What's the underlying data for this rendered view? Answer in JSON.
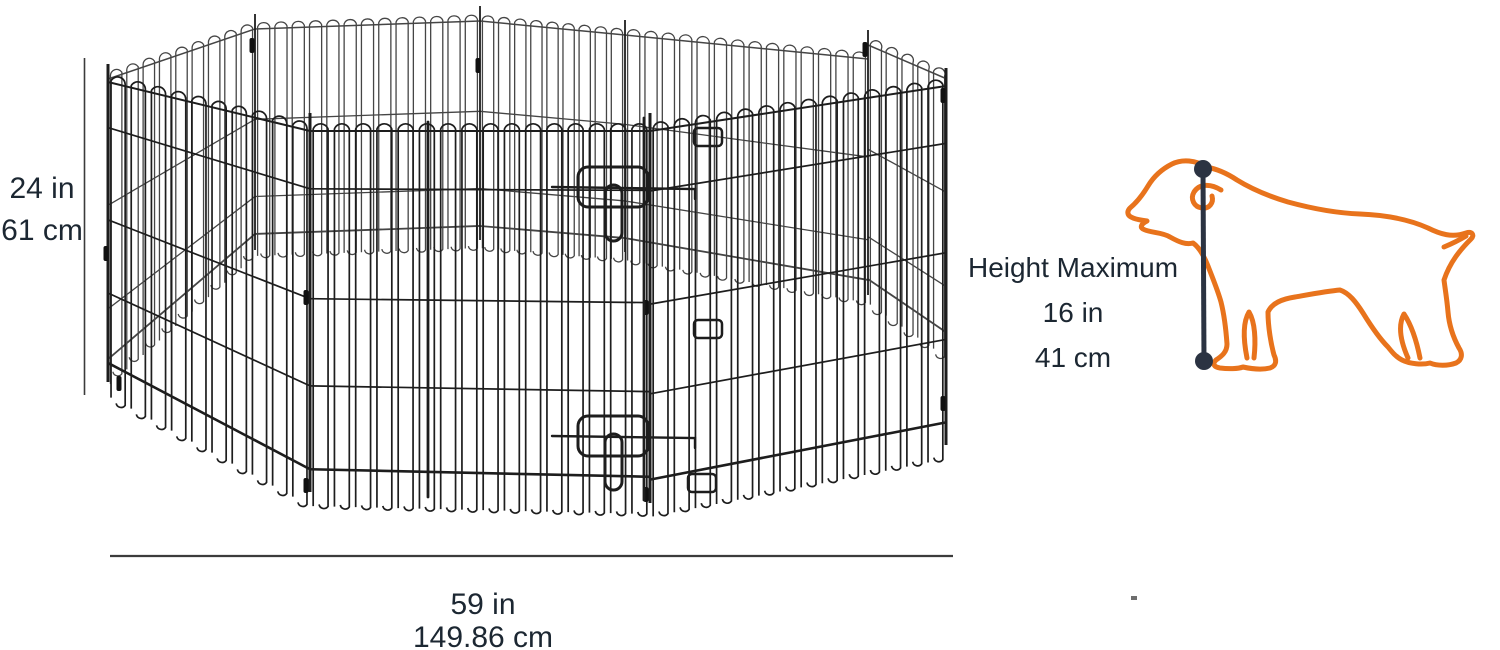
{
  "diagram": {
    "type": "product-dimensions-diagram",
    "background": "#ffffff",
    "text_color": "#1c2732",
    "dim_line_color": "#3b3b3b",
    "pen": {
      "name": "wire exercise playpen",
      "wire_color": "#1d1d1d",
      "connector_color": "#111111"
    },
    "dog": {
      "name": "dog height silhouette",
      "outline_color": "#e8731c",
      "measure_line_color": "#2b3342"
    },
    "labels": {
      "height": {
        "value_in": "24 in",
        "value_cm": "61 cm"
      },
      "width": {
        "value_in": "59 in",
        "value_cm": "149.86 cm"
      },
      "dog_height": {
        "title": "Height Maximum",
        "value_in": "16 in",
        "value_cm": "41 cm"
      }
    }
  }
}
